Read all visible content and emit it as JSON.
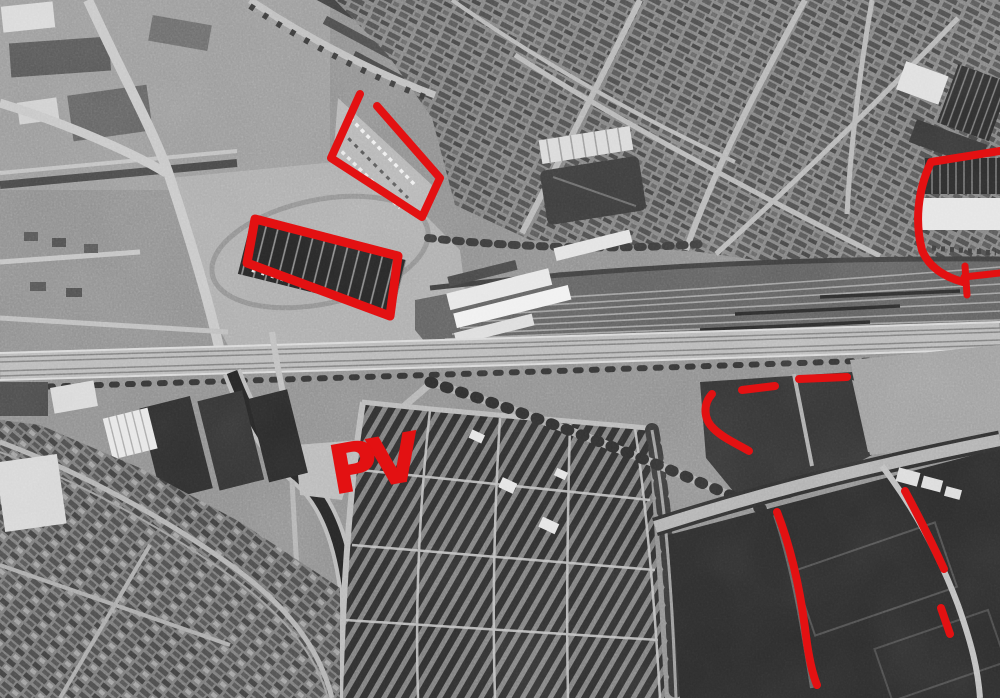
{
  "image": {
    "kind": "black-and-white aerial reconnaissance photograph",
    "subject": "urban district with railway yard, boulevard, market halls, allotment field and sports park"
  },
  "annotations": {
    "color": "#e31112",
    "pv_label": "PV",
    "shapes": [
      {
        "name": "red-outline-market-area",
        "path": "M 360,94 L 331,158 L 422,217 L 440,178 L 377,106",
        "stroke_width": 8
      },
      {
        "name": "red-outline-warehouse",
        "path": "M 255,219 L 398,256 L 390,316 L 247,263 Z",
        "stroke_width": 9
      },
      {
        "name": "red-outline-factory-right",
        "path": "M 1000,151 L 931,162 C 917,192 915,223 922,250 C 929,268 945,277 963,282",
        "stroke_width": 8
      },
      {
        "name": "red-tick-factory-right",
        "path": "M 965,266 L 967,295",
        "stroke_width": 7
      },
      {
        "name": "red-edge-line-factory-right",
        "path": "M 964,277 L 1000,273",
        "stroke_width": 7
      },
      {
        "name": "red-dash-short",
        "path": "M 742,390 L 775,386",
        "stroke_width": 8
      },
      {
        "name": "red-dash-long",
        "path": "M 799,379 L 847,377",
        "stroke_width": 8
      },
      {
        "name": "red-curve-scrub-boundary",
        "path": "M 712,394 C 703,404 703,419 714,429 C 723,438 739,445 749,451",
        "stroke_width": 8
      },
      {
        "name": "red-line-sports-field",
        "path": "M 777,512 C 791,548 800,590 805,628 C 808,654 812,673 817,685",
        "stroke_width": 8
      },
      {
        "name": "red-line-road-right",
        "path": "M 905,491 C 919,517 933,545 944,569",
        "stroke_width": 8
      },
      {
        "name": "red-dash-bottom-right",
        "path": "M 941,608 L 950,634",
        "stroke_width": 8
      }
    ]
  }
}
